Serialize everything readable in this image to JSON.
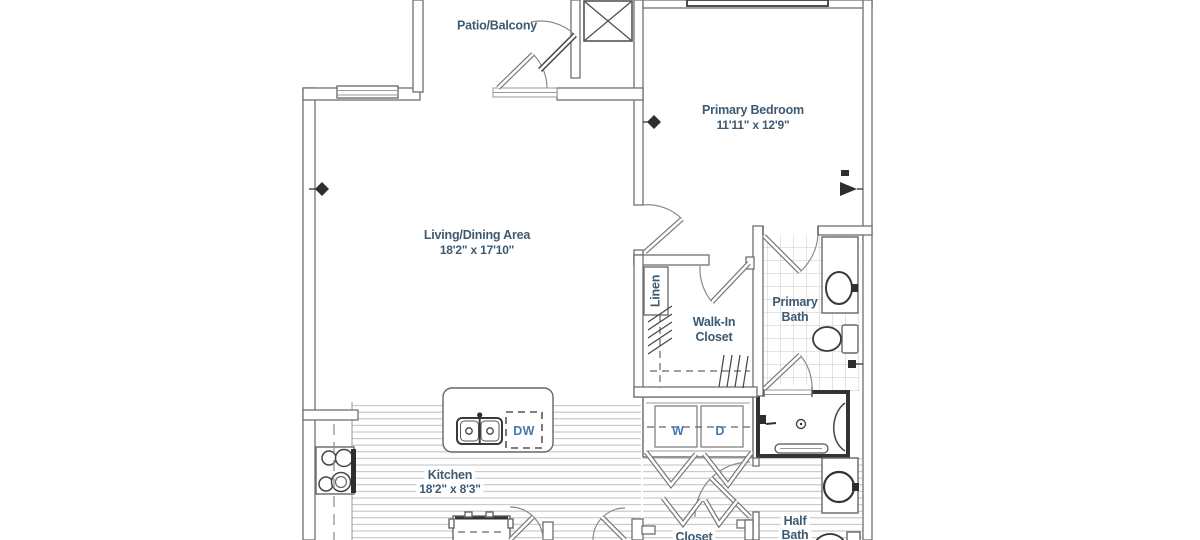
{
  "floorplan": {
    "rooms": {
      "patio_balcony": {
        "name": "Patio/Balcony"
      },
      "primary_bedroom": {
        "name": "Primary Bedroom",
        "dimensions": "11'11\" x 12'9\""
      },
      "living_dining": {
        "name": "Living/Dining Area",
        "dimensions": "18'2\" x 17'10\""
      },
      "kitchen": {
        "name": "Kitchen",
        "dimensions": "18'2\" x 8'3\""
      },
      "walk_in_closet": {
        "line1": "Walk-In",
        "line2": "Closet"
      },
      "primary_bath": {
        "line1": "Primary",
        "line2": "Bath"
      },
      "half_bath": {
        "line1": "Half",
        "line2": "Bath"
      },
      "linen_closet": {
        "name": "Linen"
      },
      "closet": {
        "name": "Closet"
      }
    },
    "appliances": {
      "washer": "W",
      "dryer": "D",
      "dishwasher": "DW"
    },
    "colors": {
      "room_label": "#3d5a73",
      "appliance_label": "#4678b0",
      "wall_line": "#6f6f6f",
      "wall_bold": "#333333",
      "tile_line": "#c9c9c9",
      "plank_line": "#bfbfbf",
      "background": "#ffffff"
    }
  }
}
